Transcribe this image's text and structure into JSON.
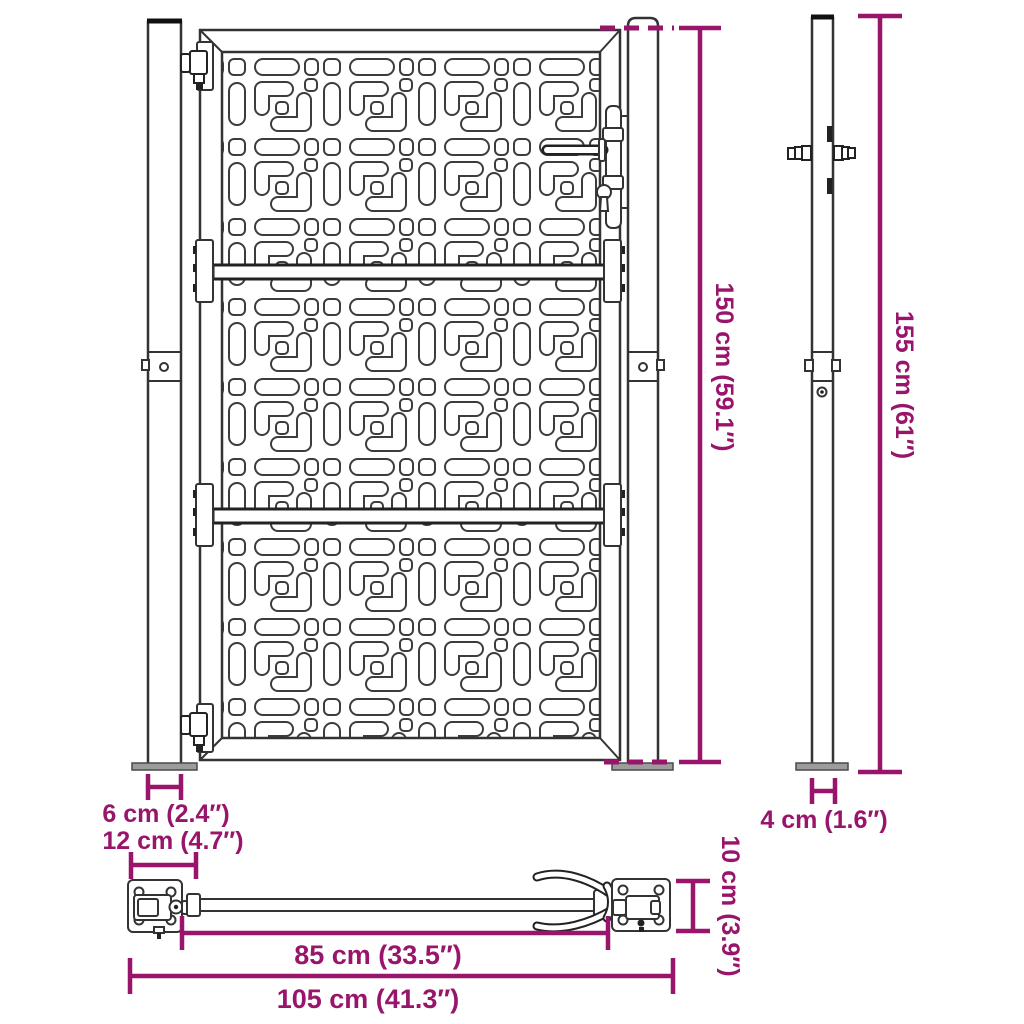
{
  "diagram": {
    "title": "Garden gate with posts — dimension diagram",
    "views": {
      "front": "gate front view with hinge and latch posts",
      "side": "post side profile",
      "bottom": "latch bar assembly top view"
    },
    "colors": {
      "dimension_annotation": "#98156b",
      "line_art": "#333333",
      "base_plate_fill": "#9c9c9c"
    }
  },
  "dims": {
    "gate_height": "150 cm (59.1″)",
    "post_height": "155 cm (61″)",
    "front_post_width": "6 cm (2.4″)",
    "front_post_base_width": "12 cm (4.7″)",
    "side_post_depth": "4 cm (1.6″)",
    "latch_plate_height": "10 cm (3.9″)",
    "latch_bar_length": "85 cm (33.5″)",
    "total_assembly_width": "105 cm (41.3″)"
  }
}
